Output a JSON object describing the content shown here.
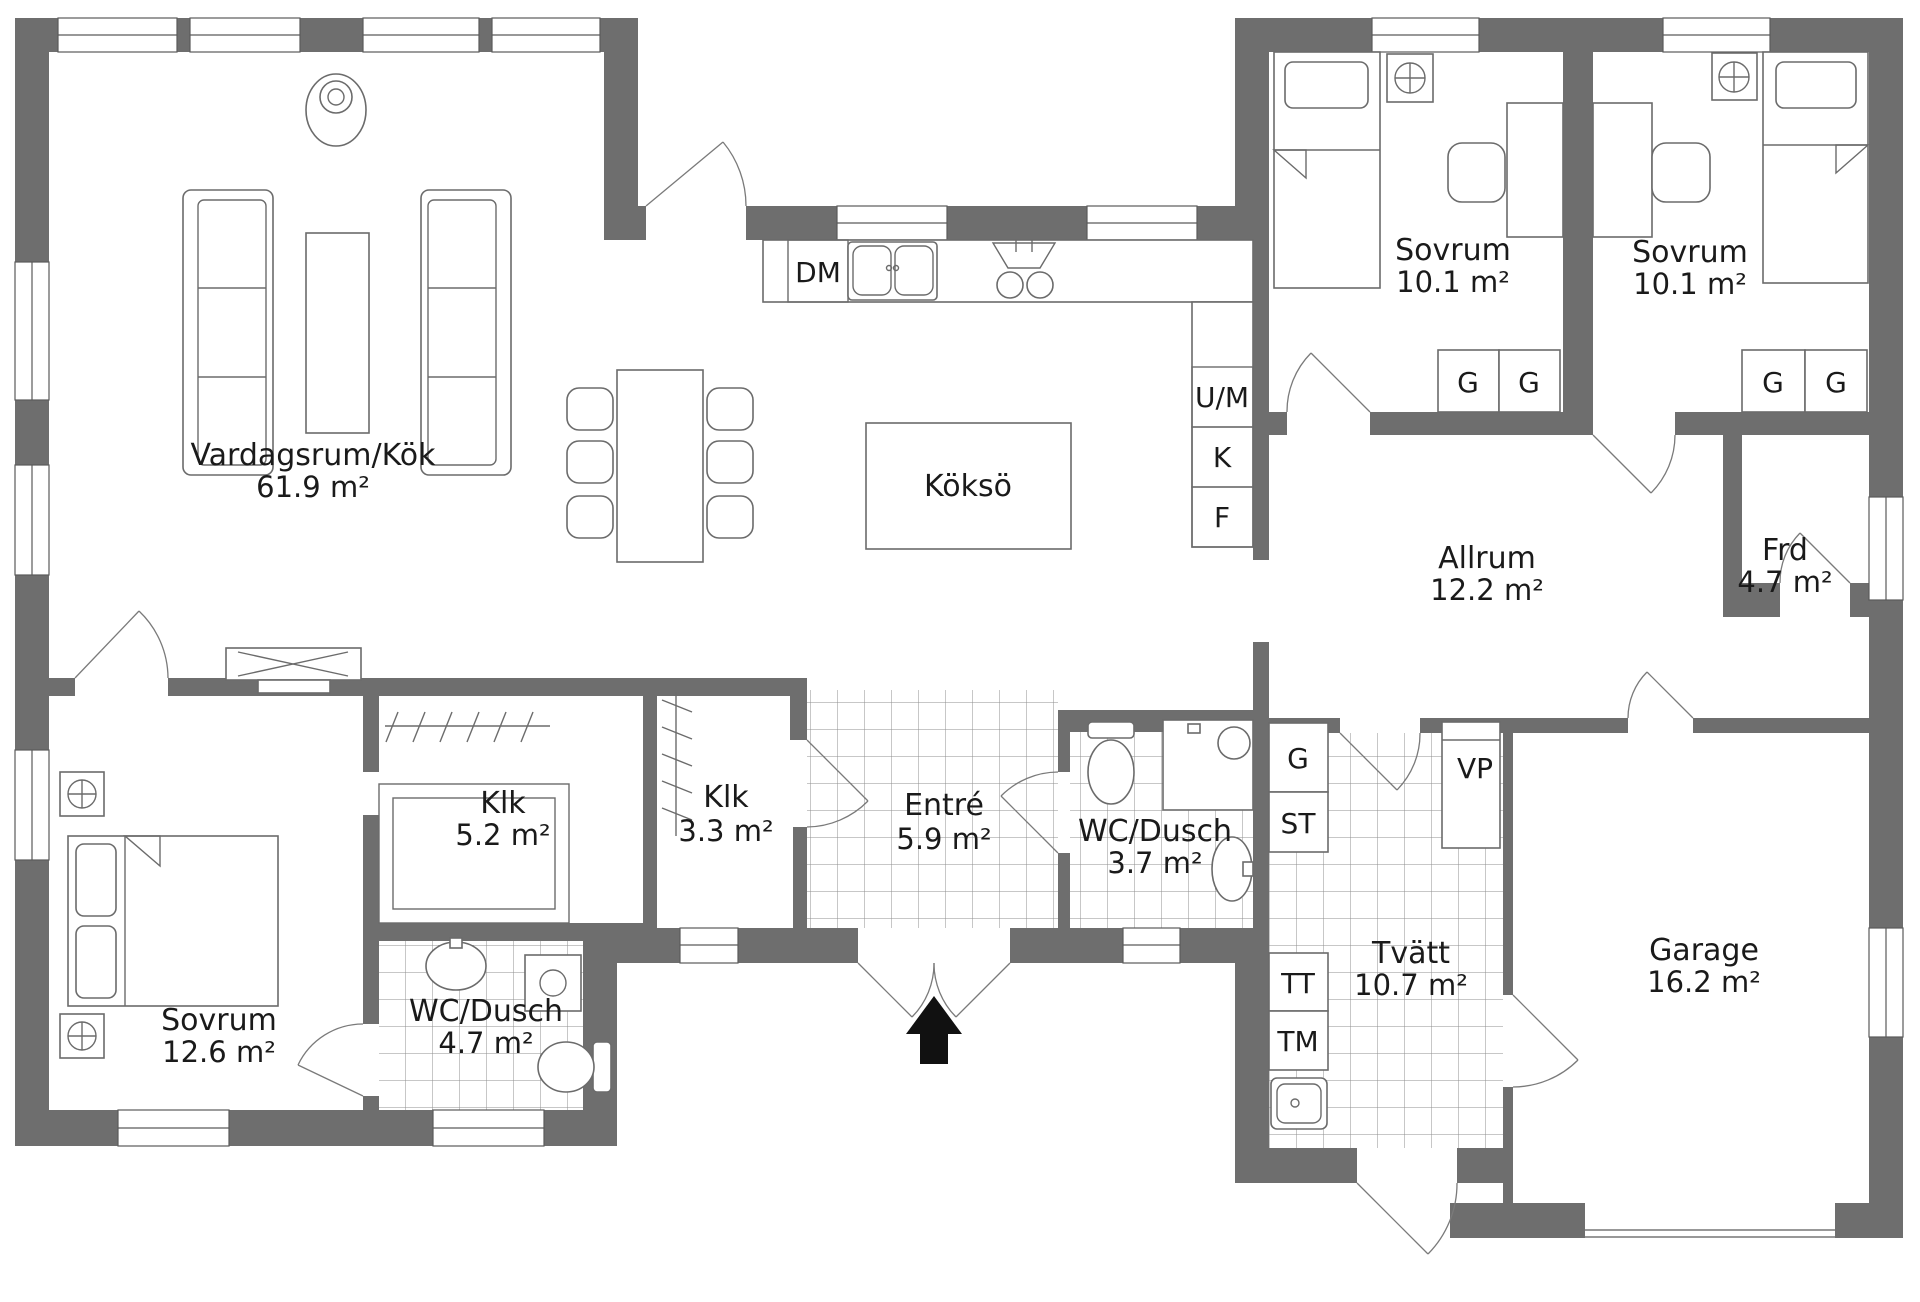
{
  "rooms": {
    "vardagsrum": {
      "name": "Vardagsrum/Kök",
      "area": "61.9 m²"
    },
    "sovrum1": {
      "name": "Sovrum",
      "area": "10.1 m²"
    },
    "sovrum2": {
      "name": "Sovrum",
      "area": "10.1 m²"
    },
    "allrum": {
      "name": "Allrum",
      "area": "12.2 m²"
    },
    "frd": {
      "name": "Frd",
      "area": "4.7 m²"
    },
    "klk_stor": {
      "name": "Klk",
      "area": "5.2 m²"
    },
    "klk_liten": {
      "name": "Klk",
      "area": "3.3 m²"
    },
    "entre": {
      "name": "Entré",
      "area": "5.9 m²"
    },
    "wc_liten": {
      "name": "WC/Dusch",
      "area": "3.7 m²"
    },
    "wc_stor": {
      "name": "WC/Dusch",
      "area": "4.7 m²"
    },
    "sovrum3": {
      "name": "Sovrum",
      "area": "12.6 m²"
    },
    "tvatt": {
      "name": "Tvätt",
      "area": "10.7 m²"
    },
    "garage": {
      "name": "Garage",
      "area": "16.2 m²"
    }
  },
  "fixtures": {
    "kokso": "Köksö",
    "dm": "DM",
    "um": "U/M",
    "kyl": "K",
    "frys": "F",
    "garderob": "G",
    "stad": "ST",
    "torktumlare": "TT",
    "tvattmaskin": "TM",
    "varmepump": "VP"
  },
  "colors": {
    "wall": "#6e6e6e",
    "line": "#6b6b6b",
    "tile": "#8f8f8f",
    "text": "#1a1a1a",
    "background": "#ffffff"
  }
}
